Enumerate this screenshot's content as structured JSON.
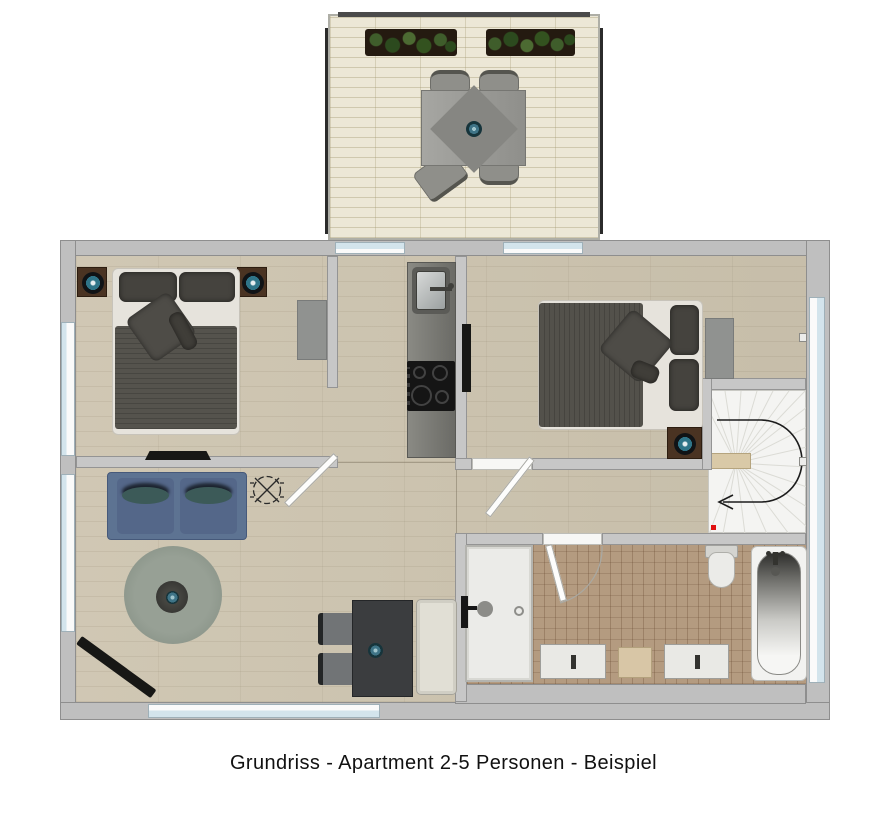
{
  "caption": {
    "text": "Grundriss - Apartment 2-5 Personen - Beispiel"
  },
  "plan": {
    "balcony": {
      "items": [
        "planter-left",
        "planter-right",
        "patio-table",
        "patio-chairs x4",
        "table-bowl"
      ]
    },
    "bedroom_1": {
      "items": [
        "double-bed",
        "nightstand x2",
        "lamp x2",
        "wall-tv",
        "dresser",
        "door"
      ]
    },
    "kitchen": {
      "items": [
        "counter",
        "sink",
        "faucet",
        "cooktop-4-burners"
      ]
    },
    "bedroom_2": {
      "items": [
        "double-bed",
        "nightstand",
        "lamp",
        "wall-tv",
        "dresser",
        "door"
      ]
    },
    "staircase": {
      "items": [
        "winder-stairs",
        "direction-arrow",
        "wood-tread",
        "red-marker"
      ]
    },
    "living": {
      "items": [
        "sofa-2-seat",
        "round-rug",
        "coffee-table",
        "bowl",
        "wall-tv-diagonal",
        "ceiling-light-symbol"
      ]
    },
    "dining": {
      "items": [
        "table",
        "chair x2",
        "bench",
        "bowl"
      ]
    },
    "bathroom": {
      "items": [
        "walk-in-shower",
        "shower-head",
        "drain",
        "toilet",
        "bathtub",
        "vanity x2",
        "wood-cabinet",
        "door-with-arc"
      ]
    },
    "openings": {
      "windows": [
        "left x2",
        "bottom x1",
        "right x1",
        "balcony-doors x2"
      ]
    }
  },
  "colors": {
    "wall": "#bfbfbf",
    "interior_wall": "#c7c7c7",
    "wood_floor": "#cdc4af",
    "bath_tile": "#b49b80",
    "balcony_tile": "#ece7d6",
    "window_glass": "#d3e4ec",
    "sofa_blue": "#5d7392",
    "accent_teal": "#3f7487",
    "dark_furniture": "#3c3e40",
    "stair_marker_red": "#e01010",
    "caption_text": "#111111"
  }
}
